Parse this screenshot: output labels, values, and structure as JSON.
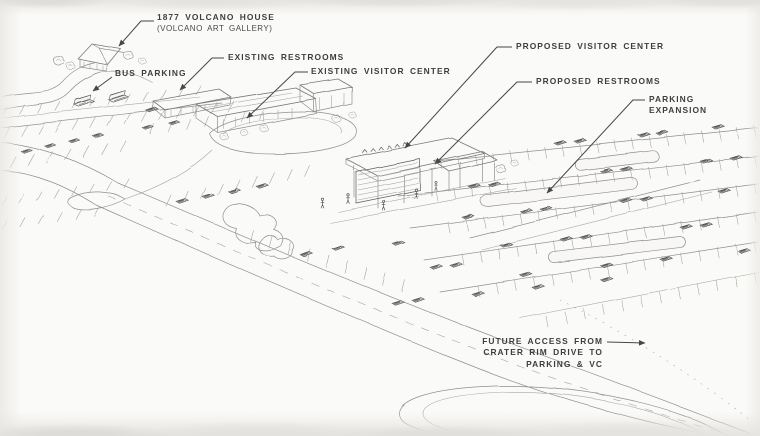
{
  "annotations": {
    "volcano_house": {
      "title": "1877 VOLCANO HOUSE",
      "subtitle": "(VOLCANO ART GALLERY)"
    },
    "bus_parking": {
      "label": "BUS PARKING"
    },
    "existing_restrooms": {
      "label": "EXISTING RESTROOMS"
    },
    "existing_visitor_center": {
      "label": "EXISTING VISITOR CENTER"
    },
    "proposed_visitor_center": {
      "label": "PROPOSED VISITOR CENTER"
    },
    "proposed_restrooms": {
      "label": "PROPOSED RESTROOMS"
    },
    "parking_expansion": {
      "line1": "PARKING",
      "line2": "EXPANSION"
    },
    "future_access": {
      "line1": "FUTURE ACCESS FROM",
      "line2": "CRATER RIM DRIVE TO",
      "line3": "PARKING & VC"
    }
  },
  "colors": {
    "label_ink": "#3e3e3e",
    "leader_ink": "#474747",
    "sketch_line": "#8f8f8f",
    "paper": "#f8f7f5"
  }
}
